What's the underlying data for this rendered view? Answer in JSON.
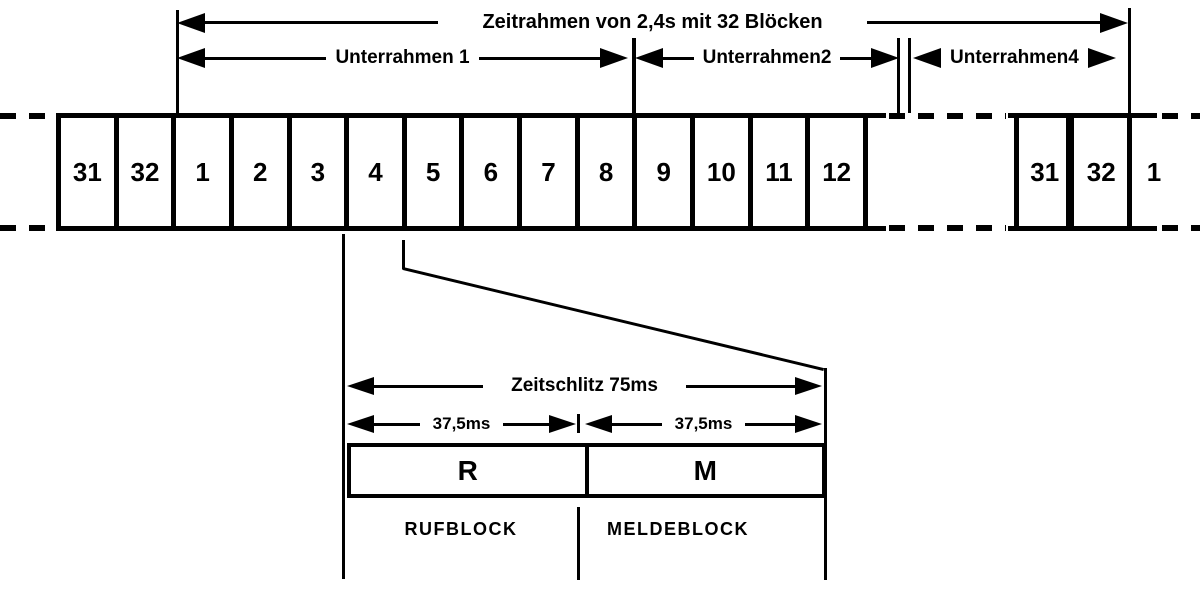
{
  "frame_arrow": "Zeitrahmen von 2,4s mit 32 Blöcken",
  "subframes": [
    "Unterrahmen 1",
    "Unterrahmen2",
    "Unterrahmen4"
  ],
  "blocks": {
    "main": [
      "31",
      "32",
      "1",
      "2",
      "3",
      "4",
      "5",
      "6",
      "7",
      "8",
      "9",
      "10",
      "11",
      "12"
    ],
    "right": [
      "31",
      "32"
    ],
    "trailing": "1"
  },
  "detail": {
    "slot": "Zeitschlitz 75ms",
    "halves": [
      "37,5ms",
      "37,5ms"
    ],
    "cells": [
      "R",
      "M"
    ],
    "names": [
      "RUFBLOCK",
      "MELDEBLOCK"
    ]
  },
  "colors": {
    "ink": "#000000",
    "paper": "#ffffff"
  }
}
